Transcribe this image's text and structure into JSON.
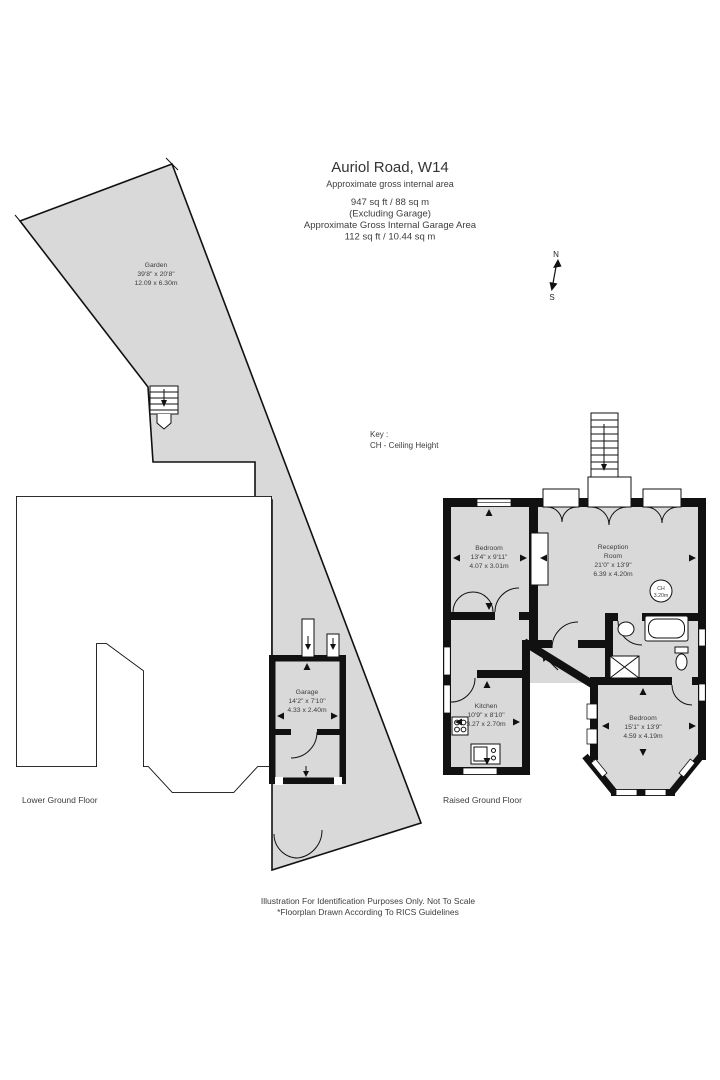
{
  "title": {
    "address": "Auriol Road, W14",
    "subtitle": "Approximate gross  internal area",
    "area1": "947 sq ft  / 88 sq m",
    "area2": "(Excluding Garage)",
    "garage_label": "Approximate Gross  Internal Garage Area",
    "garage_value": "112 sq ft /  10.44 sq m"
  },
  "compass": {
    "n": "N",
    "s": "S"
  },
  "key": {
    "heading": "Key :",
    "entry": "CH - Ceiling Height"
  },
  "rooms": {
    "garden": {
      "name": "Garden",
      "imperial": "39'8\" x 20'8\"",
      "metric": "12.09 x 6.30m"
    },
    "bedroom1": {
      "name": "Bedroom",
      "imperial": "13'4\" x 9'11\"",
      "metric": "4.07 x 3.01m"
    },
    "reception": {
      "line1": "Reception",
      "line2": "Room",
      "imperial": "21'0\" x 13'9\"",
      "metric": "6.39 x 4.20m"
    },
    "garage": {
      "name": "Garage",
      "imperial": "14'2\" x 7'10\"",
      "metric": "4.33 x 2.40m"
    },
    "kitchen": {
      "name": "Kitchen",
      "imperial": "10'9\" x 8'10\"",
      "metric": "3.27 x 2.70m"
    },
    "bedroom2": {
      "name": "Bedroom",
      "imperial": "15'1\" x 13'9\"",
      "metric": "4.59 x 4.19m"
    }
  },
  "ch_badge": {
    "l1": "CH",
    "l2": "3.20m"
  },
  "floors": {
    "lower": "Lower Ground Floor",
    "raised": "Raised Ground Floor"
  },
  "footer": {
    "line1": "Illustration For Identification Purposes Only. Not To Scale",
    "line2": "*Floorplan Drawn According To RICS Guidelines"
  },
  "colors": {
    "plan_fill": "#d9d9d9",
    "wall": "#111111",
    "text": "#3d3d3d"
  }
}
